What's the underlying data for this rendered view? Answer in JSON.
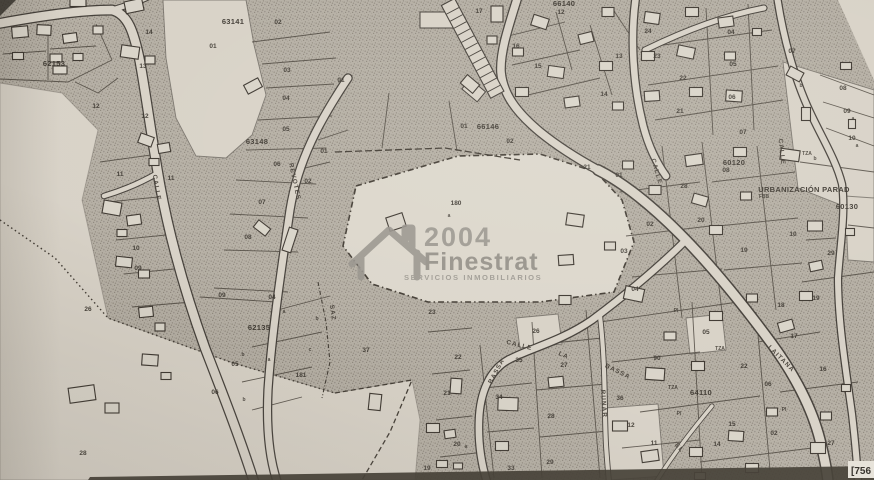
{
  "map": {
    "kind": "cadastral-plan-photo",
    "watermark": {
      "line1": "2004",
      "line2": "Finestrat",
      "subtitle": "SERVICIOS INMOBILIARIOS"
    },
    "corner_ref": "[756",
    "colors": {
      "paper": "#d8d2c7",
      "paper_light": "#dcd7cc",
      "stipple_base": "#b5afa4",
      "stipple_dot": "#8e887d",
      "line": "#474138",
      "text": "#3a352e",
      "watermark": "#98948d",
      "photo_edge": "#3f3930"
    },
    "street_labels": [
      {
        "t": "CALLE",
        "x": 155,
        "y": 188,
        "r": 80
      },
      {
        "t": "REVOTES",
        "x": 293,
        "y": 182,
        "r": 78
      },
      {
        "t": "CALLE",
        "x": 655,
        "y": 172,
        "r": 74
      },
      {
        "t": "CALLE",
        "x": 780,
        "y": 152,
        "r": 84
      },
      {
        "t": "CALLE",
        "x": 519,
        "y": 347,
        "r": 14
      },
      {
        "t": "BASSA",
        "x": 498,
        "y": 372,
        "r": -62
      },
      {
        "t": "LA",
        "x": 563,
        "y": 357,
        "r": 22
      },
      {
        "t": "BASSA",
        "x": 617,
        "y": 373,
        "r": 26
      },
      {
        "t": "RUNAR",
        "x": 602,
        "y": 404,
        "r": 86
      },
      {
        "t": "LAITANA",
        "x": 780,
        "y": 360,
        "r": 45
      },
      {
        "t": "EL",
        "x": 678,
        "y": 449,
        "r": 48
      },
      {
        "t": "SAZ",
        "x": 331,
        "y": 313,
        "r": 82
      }
    ],
    "block_labels": [
      {
        "t": "63141",
        "x": 233,
        "y": 24,
        "s": 8
      },
      {
        "t": "62153",
        "x": 54,
        "y": 66,
        "s": 7.5
      },
      {
        "t": "63148",
        "x": 257,
        "y": 144,
        "s": 7.5
      },
      {
        "t": "66140",
        "x": 564,
        "y": 6,
        "s": 6.5
      },
      {
        "t": "66146",
        "x": 488,
        "y": 129,
        "s": 8
      },
      {
        "t": "62135",
        "x": 259,
        "y": 330,
        "s": 7.5
      },
      {
        "t": "64110",
        "x": 701,
        "y": 395,
        "s": 7.5
      },
      {
        "t": "60120",
        "x": 734,
        "y": 165,
        "s": 7
      },
      {
        "t": "60130",
        "x": 847,
        "y": 209,
        "s": 8
      },
      {
        "t": "URBANIZACIÓN PARAD",
        "x": 804,
        "y": 192,
        "s": 6.2,
        "a": "s"
      }
    ],
    "parcel_labels": [
      {
        "t": "01",
        "x": 213,
        "y": 48
      },
      {
        "t": "02",
        "x": 278,
        "y": 24
      },
      {
        "t": "03",
        "x": 287,
        "y": 72
      },
      {
        "t": "04",
        "x": 286,
        "y": 100
      },
      {
        "t": "05",
        "x": 286,
        "y": 131
      },
      {
        "t": "06",
        "x": 277,
        "y": 166
      },
      {
        "t": "07",
        "x": 262,
        "y": 204
      },
      {
        "t": "08",
        "x": 248,
        "y": 239
      },
      {
        "t": "09",
        "x": 222,
        "y": 297
      },
      {
        "t": "04",
        "x": 272,
        "y": 299
      },
      {
        "t": "14",
        "x": 149,
        "y": 34
      },
      {
        "t": "13",
        "x": 143,
        "y": 68
      },
      {
        "t": "12",
        "x": 96,
        "y": 108
      },
      {
        "t": "12",
        "x": 145,
        "y": 118
      },
      {
        "t": "11",
        "x": 120,
        "y": 176
      },
      {
        "t": "11",
        "x": 171,
        "y": 180
      },
      {
        "t": "10",
        "x": 136,
        "y": 250
      },
      {
        "t": "09",
        "x": 138,
        "y": 270
      },
      {
        "t": "26",
        "x": 88,
        "y": 311
      },
      {
        "t": "28",
        "x": 83,
        "y": 455
      },
      {
        "t": "05",
        "x": 235,
        "y": 366
      },
      {
        "t": "06",
        "x": 215,
        "y": 394
      },
      {
        "t": "181",
        "x": 301,
        "y": 377
      },
      {
        "t": "01",
        "x": 324,
        "y": 153
      },
      {
        "t": "02",
        "x": 308,
        "y": 183
      },
      {
        "t": "01",
        "x": 341,
        "y": 82
      },
      {
        "t": "17",
        "x": 479,
        "y": 13
      },
      {
        "t": "16",
        "x": 516,
        "y": 48
      },
      {
        "t": "15",
        "x": 538,
        "y": 68
      },
      {
        "t": "12",
        "x": 561,
        "y": 14
      },
      {
        "t": "13",
        "x": 619,
        "y": 58
      },
      {
        "t": "14",
        "x": 604,
        "y": 96
      },
      {
        "t": "01",
        "x": 464,
        "y": 128
      },
      {
        "t": "02",
        "x": 510,
        "y": 143
      },
      {
        "t": "21",
        "x": 587,
        "y": 169
      },
      {
        "t": "180",
        "x": 456,
        "y": 205
      },
      {
        "t": "24",
        "x": 648,
        "y": 33
      },
      {
        "t": "23",
        "x": 657,
        "y": 58
      },
      {
        "t": "22",
        "x": 683,
        "y": 80
      },
      {
        "t": "21",
        "x": 680,
        "y": 113
      },
      {
        "t": "04",
        "x": 731,
        "y": 34
      },
      {
        "t": "05",
        "x": 733,
        "y": 66
      },
      {
        "t": "06",
        "x": 732,
        "y": 99
      },
      {
        "t": "07",
        "x": 743,
        "y": 134
      },
      {
        "t": "07",
        "x": 792,
        "y": 53
      },
      {
        "t": "08",
        "x": 843,
        "y": 90
      },
      {
        "t": "09",
        "x": 847,
        "y": 113
      },
      {
        "t": "10",
        "x": 852,
        "y": 140
      },
      {
        "t": "08",
        "x": 726,
        "y": 172
      },
      {
        "t": "28",
        "x": 684,
        "y": 188
      },
      {
        "t": "01",
        "x": 619,
        "y": 177
      },
      {
        "t": "02",
        "x": 650,
        "y": 226
      },
      {
        "t": "03",
        "x": 624,
        "y": 253
      },
      {
        "t": "04",
        "x": 635,
        "y": 291
      },
      {
        "t": "20",
        "x": 701,
        "y": 222
      },
      {
        "t": "19",
        "x": 744,
        "y": 252
      },
      {
        "t": "10",
        "x": 793,
        "y": 236
      },
      {
        "t": "29",
        "x": 831,
        "y": 255
      },
      {
        "t": "19",
        "x": 816,
        "y": 300
      },
      {
        "t": "18",
        "x": 781,
        "y": 307
      },
      {
        "t": "17",
        "x": 794,
        "y": 338
      },
      {
        "t": "16",
        "x": 823,
        "y": 371
      },
      {
        "t": "37",
        "x": 366,
        "y": 352
      },
      {
        "t": "23",
        "x": 432,
        "y": 314
      },
      {
        "t": "22",
        "x": 458,
        "y": 359
      },
      {
        "t": "21",
        "x": 447,
        "y": 395
      },
      {
        "t": "20",
        "x": 457,
        "y": 446
      },
      {
        "t": "19",
        "x": 427,
        "y": 470
      },
      {
        "t": "34",
        "x": 499,
        "y": 399
      },
      {
        "t": "33",
        "x": 511,
        "y": 470
      },
      {
        "t": "35",
        "x": 519,
        "y": 362
      },
      {
        "t": "26",
        "x": 536,
        "y": 333
      },
      {
        "t": "27",
        "x": 564,
        "y": 367
      },
      {
        "t": "28",
        "x": 551,
        "y": 418
      },
      {
        "t": "29",
        "x": 550,
        "y": 464
      },
      {
        "t": "05",
        "x": 706,
        "y": 334
      },
      {
        "t": "90",
        "x": 657,
        "y": 360
      },
      {
        "t": "22",
        "x": 744,
        "y": 368
      },
      {
        "t": "06",
        "x": 768,
        "y": 386
      },
      {
        "t": "36",
        "x": 620,
        "y": 400
      },
      {
        "t": "12",
        "x": 631,
        "y": 427
      },
      {
        "t": "11",
        "x": 654,
        "y": 445
      },
      {
        "t": "15",
        "x": 732,
        "y": 426
      },
      {
        "t": "14",
        "x": 717,
        "y": 446
      },
      {
        "t": "27",
        "x": 831,
        "y": 445
      },
      {
        "t": "02",
        "x": 774,
        "y": 435
      }
    ],
    "sub_labels": [
      {
        "t": "TZA",
        "x": 807,
        "y": 155
      },
      {
        "t": "TZA",
        "x": 720,
        "y": 350
      },
      {
        "t": "TZA",
        "x": 673,
        "y": 389
      },
      {
        "t": "PI",
        "x": 676,
        "y": 312
      },
      {
        "t": "PI",
        "x": 679,
        "y": 415
      },
      {
        "t": "PI",
        "x": 784,
        "y": 411
      },
      {
        "t": "FBB",
        "x": 764,
        "y": 198
      },
      {
        "t": "a",
        "x": 449,
        "y": 217
      },
      {
        "t": "a",
        "x": 269,
        "y": 361
      },
      {
        "t": "a",
        "x": 284,
        "y": 313
      },
      {
        "t": "a",
        "x": 853,
        "y": 120
      },
      {
        "t": "a",
        "x": 857,
        "y": 147
      },
      {
        "t": "a",
        "x": 466,
        "y": 448
      },
      {
        "t": "b",
        "x": 801,
        "y": 87
      },
      {
        "t": "b",
        "x": 815,
        "y": 160
      },
      {
        "t": "b",
        "x": 243,
        "y": 356
      },
      {
        "t": "b",
        "x": 244,
        "y": 401
      },
      {
        "t": "b",
        "x": 317,
        "y": 320
      },
      {
        "t": "c",
        "x": 310,
        "y": 351
      }
    ],
    "buildings": [
      [
        20,
        32,
        16,
        11,
        -5
      ],
      [
        44,
        30,
        14,
        10,
        3
      ],
      [
        70,
        38,
        14,
        9,
        -8
      ],
      [
        18,
        56,
        11,
        7,
        0
      ],
      [
        56,
        58,
        12,
        8,
        0
      ],
      [
        78,
        57,
        10,
        7,
        0
      ],
      [
        60,
        70,
        14,
        8,
        0
      ],
      [
        98,
        30,
        10,
        8,
        0
      ],
      [
        134,
        6,
        18,
        12,
        -12
      ],
      [
        130,
        52,
        18,
        12,
        8
      ],
      [
        150,
        60,
        10,
        8,
        0
      ],
      [
        78,
        2,
        16,
        9,
        0
      ],
      [
        146,
        140,
        14,
        10,
        20
      ],
      [
        164,
        148,
        12,
        9,
        -10
      ],
      [
        154,
        162,
        10,
        7,
        0
      ],
      [
        112,
        208,
        18,
        13,
        10
      ],
      [
        134,
        220,
        14,
        10,
        -8
      ],
      [
        122,
        233,
        10,
        7,
        0
      ],
      [
        124,
        262,
        16,
        10,
        6
      ],
      [
        144,
        274,
        11,
        8,
        0
      ],
      [
        146,
        312,
        14,
        10,
        -6
      ],
      [
        160,
        327,
        10,
        8,
        0
      ],
      [
        150,
        360,
        16,
        11,
        4
      ],
      [
        166,
        376,
        10,
        7,
        0
      ],
      [
        82,
        394,
        26,
        15,
        -8
      ],
      [
        112,
        408,
        14,
        10,
        0
      ],
      [
        253,
        86,
        16,
        10,
        -28
      ],
      [
        262,
        228,
        15,
        9,
        38
      ],
      [
        290,
        240,
        9,
        24,
        18
      ],
      [
        470,
        84,
        16,
        11,
        40
      ],
      [
        497,
        14,
        12,
        16,
        0
      ],
      [
        492,
        40,
        10,
        8,
        0
      ],
      [
        396,
        222,
        17,
        14,
        -18
      ],
      [
        540,
        22,
        16,
        11,
        18
      ],
      [
        586,
        38,
        14,
        10,
        -14
      ],
      [
        608,
        12,
        12,
        9,
        0
      ],
      [
        518,
        52,
        11,
        8,
        0
      ],
      [
        556,
        72,
        16,
        11,
        8
      ],
      [
        606,
        66,
        13,
        9,
        0
      ],
      [
        522,
        92,
        13,
        9,
        0
      ],
      [
        572,
        102,
        15,
        10,
        -8
      ],
      [
        618,
        106,
        11,
        8,
        0
      ],
      [
        652,
        18,
        15,
        11,
        8
      ],
      [
        692,
        12,
        13,
        9,
        0
      ],
      [
        726,
        22,
        15,
        10,
        -8
      ],
      [
        648,
        56,
        13,
        9,
        0
      ],
      [
        686,
        52,
        17,
        11,
        12
      ],
      [
        730,
        56,
        11,
        8,
        0
      ],
      [
        652,
        96,
        15,
        10,
        -4
      ],
      [
        696,
        92,
        13,
        9,
        0
      ],
      [
        734,
        96,
        16,
        11,
        4
      ],
      [
        757,
        32,
        9,
        7,
        0
      ],
      [
        795,
        74,
        15,
        10,
        28
      ],
      [
        846,
        66,
        11,
        7,
        0
      ],
      [
        806,
        114,
        9,
        13,
        0
      ],
      [
        790,
        155,
        19,
        11,
        8
      ],
      [
        852,
        124,
        7,
        9,
        0
      ],
      [
        694,
        160,
        17,
        11,
        -8
      ],
      [
        740,
        152,
        13,
        9,
        0
      ],
      [
        700,
        200,
        15,
        10,
        16
      ],
      [
        746,
        196,
        11,
        8,
        0
      ],
      [
        716,
        230,
        13,
        9,
        0
      ],
      [
        655,
        190,
        12,
        9,
        0
      ],
      [
        628,
        165,
        11,
        8,
        0
      ],
      [
        815,
        226,
        15,
        10,
        0
      ],
      [
        850,
        232,
        9,
        7,
        0
      ],
      [
        816,
        266,
        13,
        9,
        -12
      ],
      [
        575,
        220,
        17,
        12,
        8
      ],
      [
        566,
        260,
        15,
        10,
        -4
      ],
      [
        634,
        294,
        19,
        13,
        12
      ],
      [
        610,
        246,
        11,
        8,
        0
      ],
      [
        565,
        300,
        12,
        9,
        0
      ],
      [
        655,
        374,
        19,
        12,
        4
      ],
      [
        698,
        366,
        13,
        9,
        0
      ],
      [
        670,
        336,
        12,
        8,
        0
      ],
      [
        620,
        426,
        15,
        10,
        0
      ],
      [
        650,
        456,
        17,
        11,
        -8
      ],
      [
        696,
        452,
        13,
        9,
        0
      ],
      [
        736,
        436,
        15,
        10,
        4
      ],
      [
        772,
        412,
        11,
        8,
        0
      ],
      [
        806,
        296,
        13,
        9,
        0
      ],
      [
        786,
        326,
        15,
        10,
        -16
      ],
      [
        826,
        416,
        11,
        8,
        0
      ],
      [
        846,
        388,
        9,
        7,
        0
      ],
      [
        716,
        316,
        13,
        9,
        0
      ],
      [
        752,
        298,
        11,
        8,
        0
      ],
      [
        818,
        448,
        15,
        11,
        0
      ],
      [
        752,
        468,
        13,
        9,
        0
      ],
      [
        700,
        476,
        11,
        7,
        0
      ],
      [
        508,
        404,
        20,
        13,
        2
      ],
      [
        502,
        446,
        13,
        9,
        0
      ],
      [
        556,
        382,
        15,
        10,
        -6
      ],
      [
        375,
        402,
        12,
        16,
        6
      ],
      [
        433,
        428,
        13,
        9,
        0
      ],
      [
        450,
        434,
        11,
        8,
        -8
      ],
      [
        456,
        386,
        11,
        15,
        4
      ],
      [
        442,
        464,
        11,
        7,
        0
      ],
      [
        458,
        466,
        9,
        6,
        0
      ]
    ]
  }
}
